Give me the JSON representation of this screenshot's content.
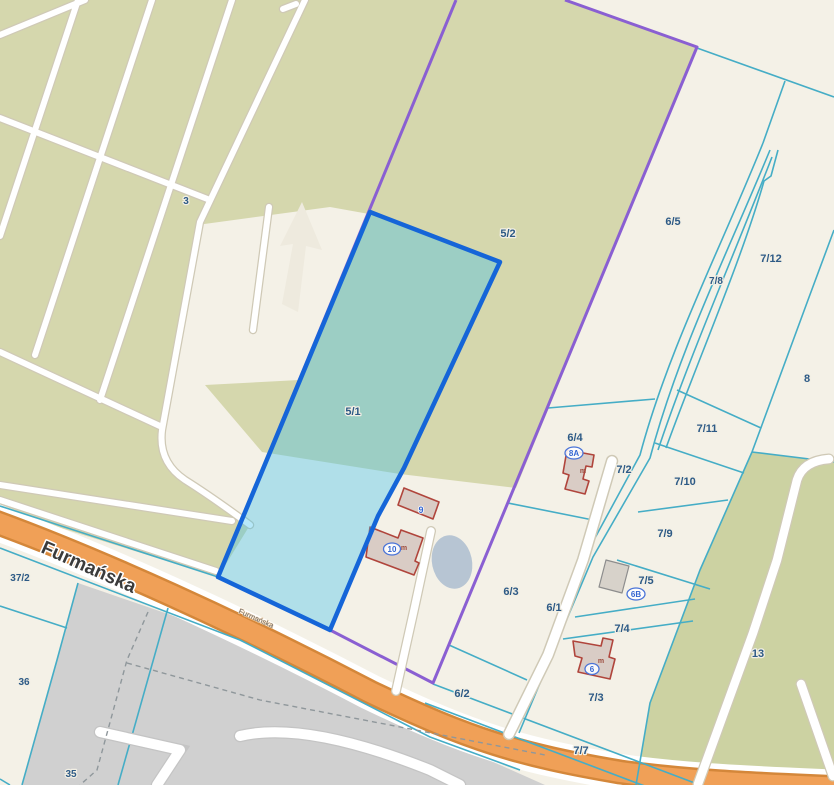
{
  "map": {
    "street": {
      "main": "Furmańska",
      "repeat": "Furmańska"
    },
    "selected_parcel": {
      "id": "5/1"
    },
    "parcel_labels": {
      "p3": "3",
      "p5_1": "5/1",
      "p5_2": "5/2",
      "p6_5": "6/5",
      "p7_8": "7/8",
      "p7_12": "7/12",
      "p8": "8",
      "p7_11": "7/11",
      "p7_2": "7/2",
      "p6_4": "6/4",
      "p7_10": "7/10",
      "p7_9": "7/9",
      "p7_5": "7/5",
      "p7_4": "7/4",
      "p6_3": "6/3",
      "p6_1": "6/1",
      "p6_2": "6/2",
      "p7_3": "7/3",
      "p7_7": "7/7",
      "p13": "13",
      "p37_2": "37/2",
      "p36": "36",
      "p35": "35"
    },
    "address_labels": {
      "a8A": "8A",
      "a6B": "6B",
      "a6": "6",
      "a9": "9",
      "a10": "10",
      "m": "m"
    },
    "colors": {
      "background_cream": "#f4f1e7",
      "field_green": "#d5d7ad",
      "selection_border_blue": "#1565d8",
      "selection_fill": "rgba(56,191,238,0.36)",
      "boundary_purple": "#8a5fd2",
      "parcel_line_cyan": "#45adc6",
      "road_orange": "#f0a057",
      "road_casing": "#d4873a",
      "parking_gray": "#d0d0d0",
      "pond_blue_gray": "#b7c5d3",
      "building_outline_red": "#b0453c",
      "building_fill": "#d9ccc5",
      "label_blue": "#2d5a86",
      "address_blue": "#3465d0"
    }
  }
}
